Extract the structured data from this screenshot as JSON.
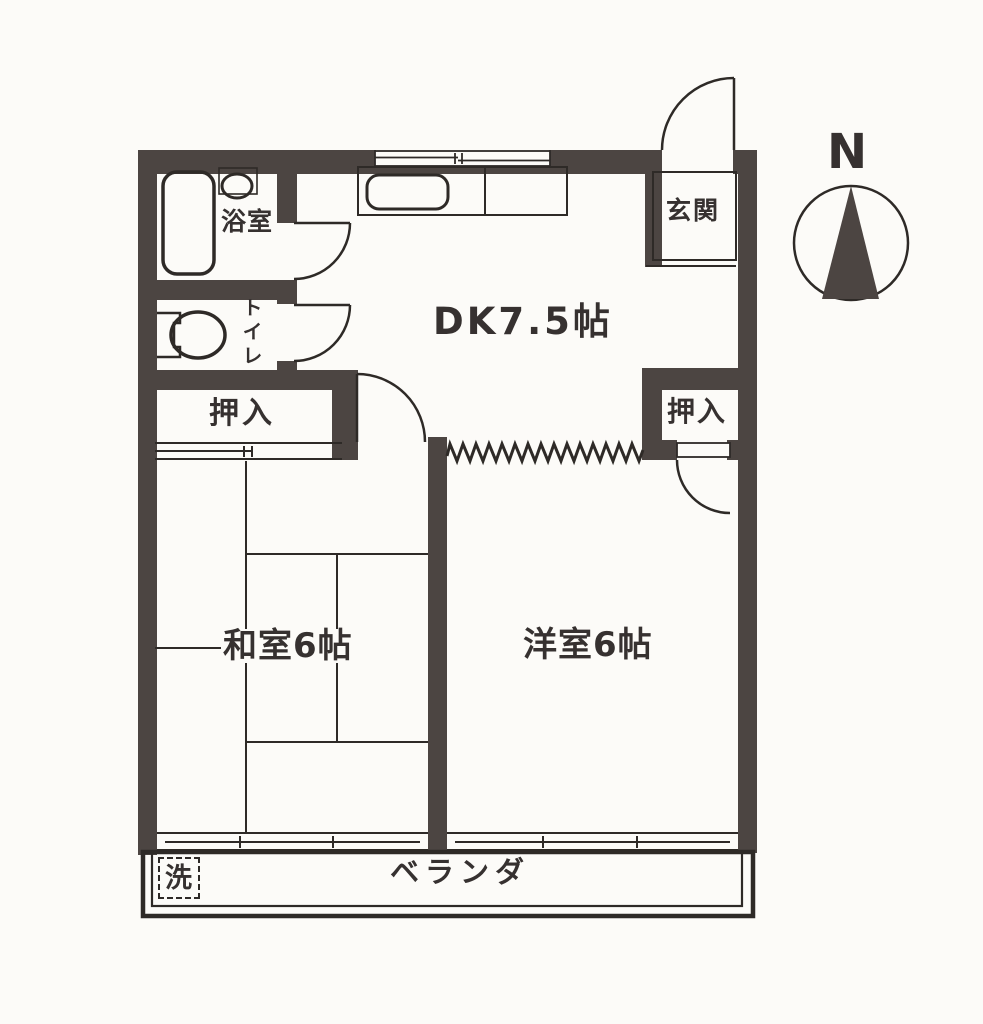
{
  "floor_plan": {
    "rooms": {
      "bathroom": {
        "label": "浴室"
      },
      "toilet": {
        "label": "トイレ"
      },
      "closet_upper": {
        "label": "押入"
      },
      "closet_right": {
        "label": "押入"
      },
      "entrance": {
        "label": "玄関"
      },
      "dining_kitchen": {
        "label": "DK7.5帖"
      },
      "japanese_room": {
        "label": "和室6帖"
      },
      "western_room": {
        "label": "洋室6帖"
      },
      "veranda": {
        "label": "ベランダ"
      },
      "washing_machine": {
        "label": "洗"
      }
    },
    "compass": {
      "north_label": "N"
    },
    "colors": {
      "wall": "#4c4542",
      "line": "#2e2a27",
      "text": "#363130",
      "paper": "#fcfbf8"
    }
  }
}
